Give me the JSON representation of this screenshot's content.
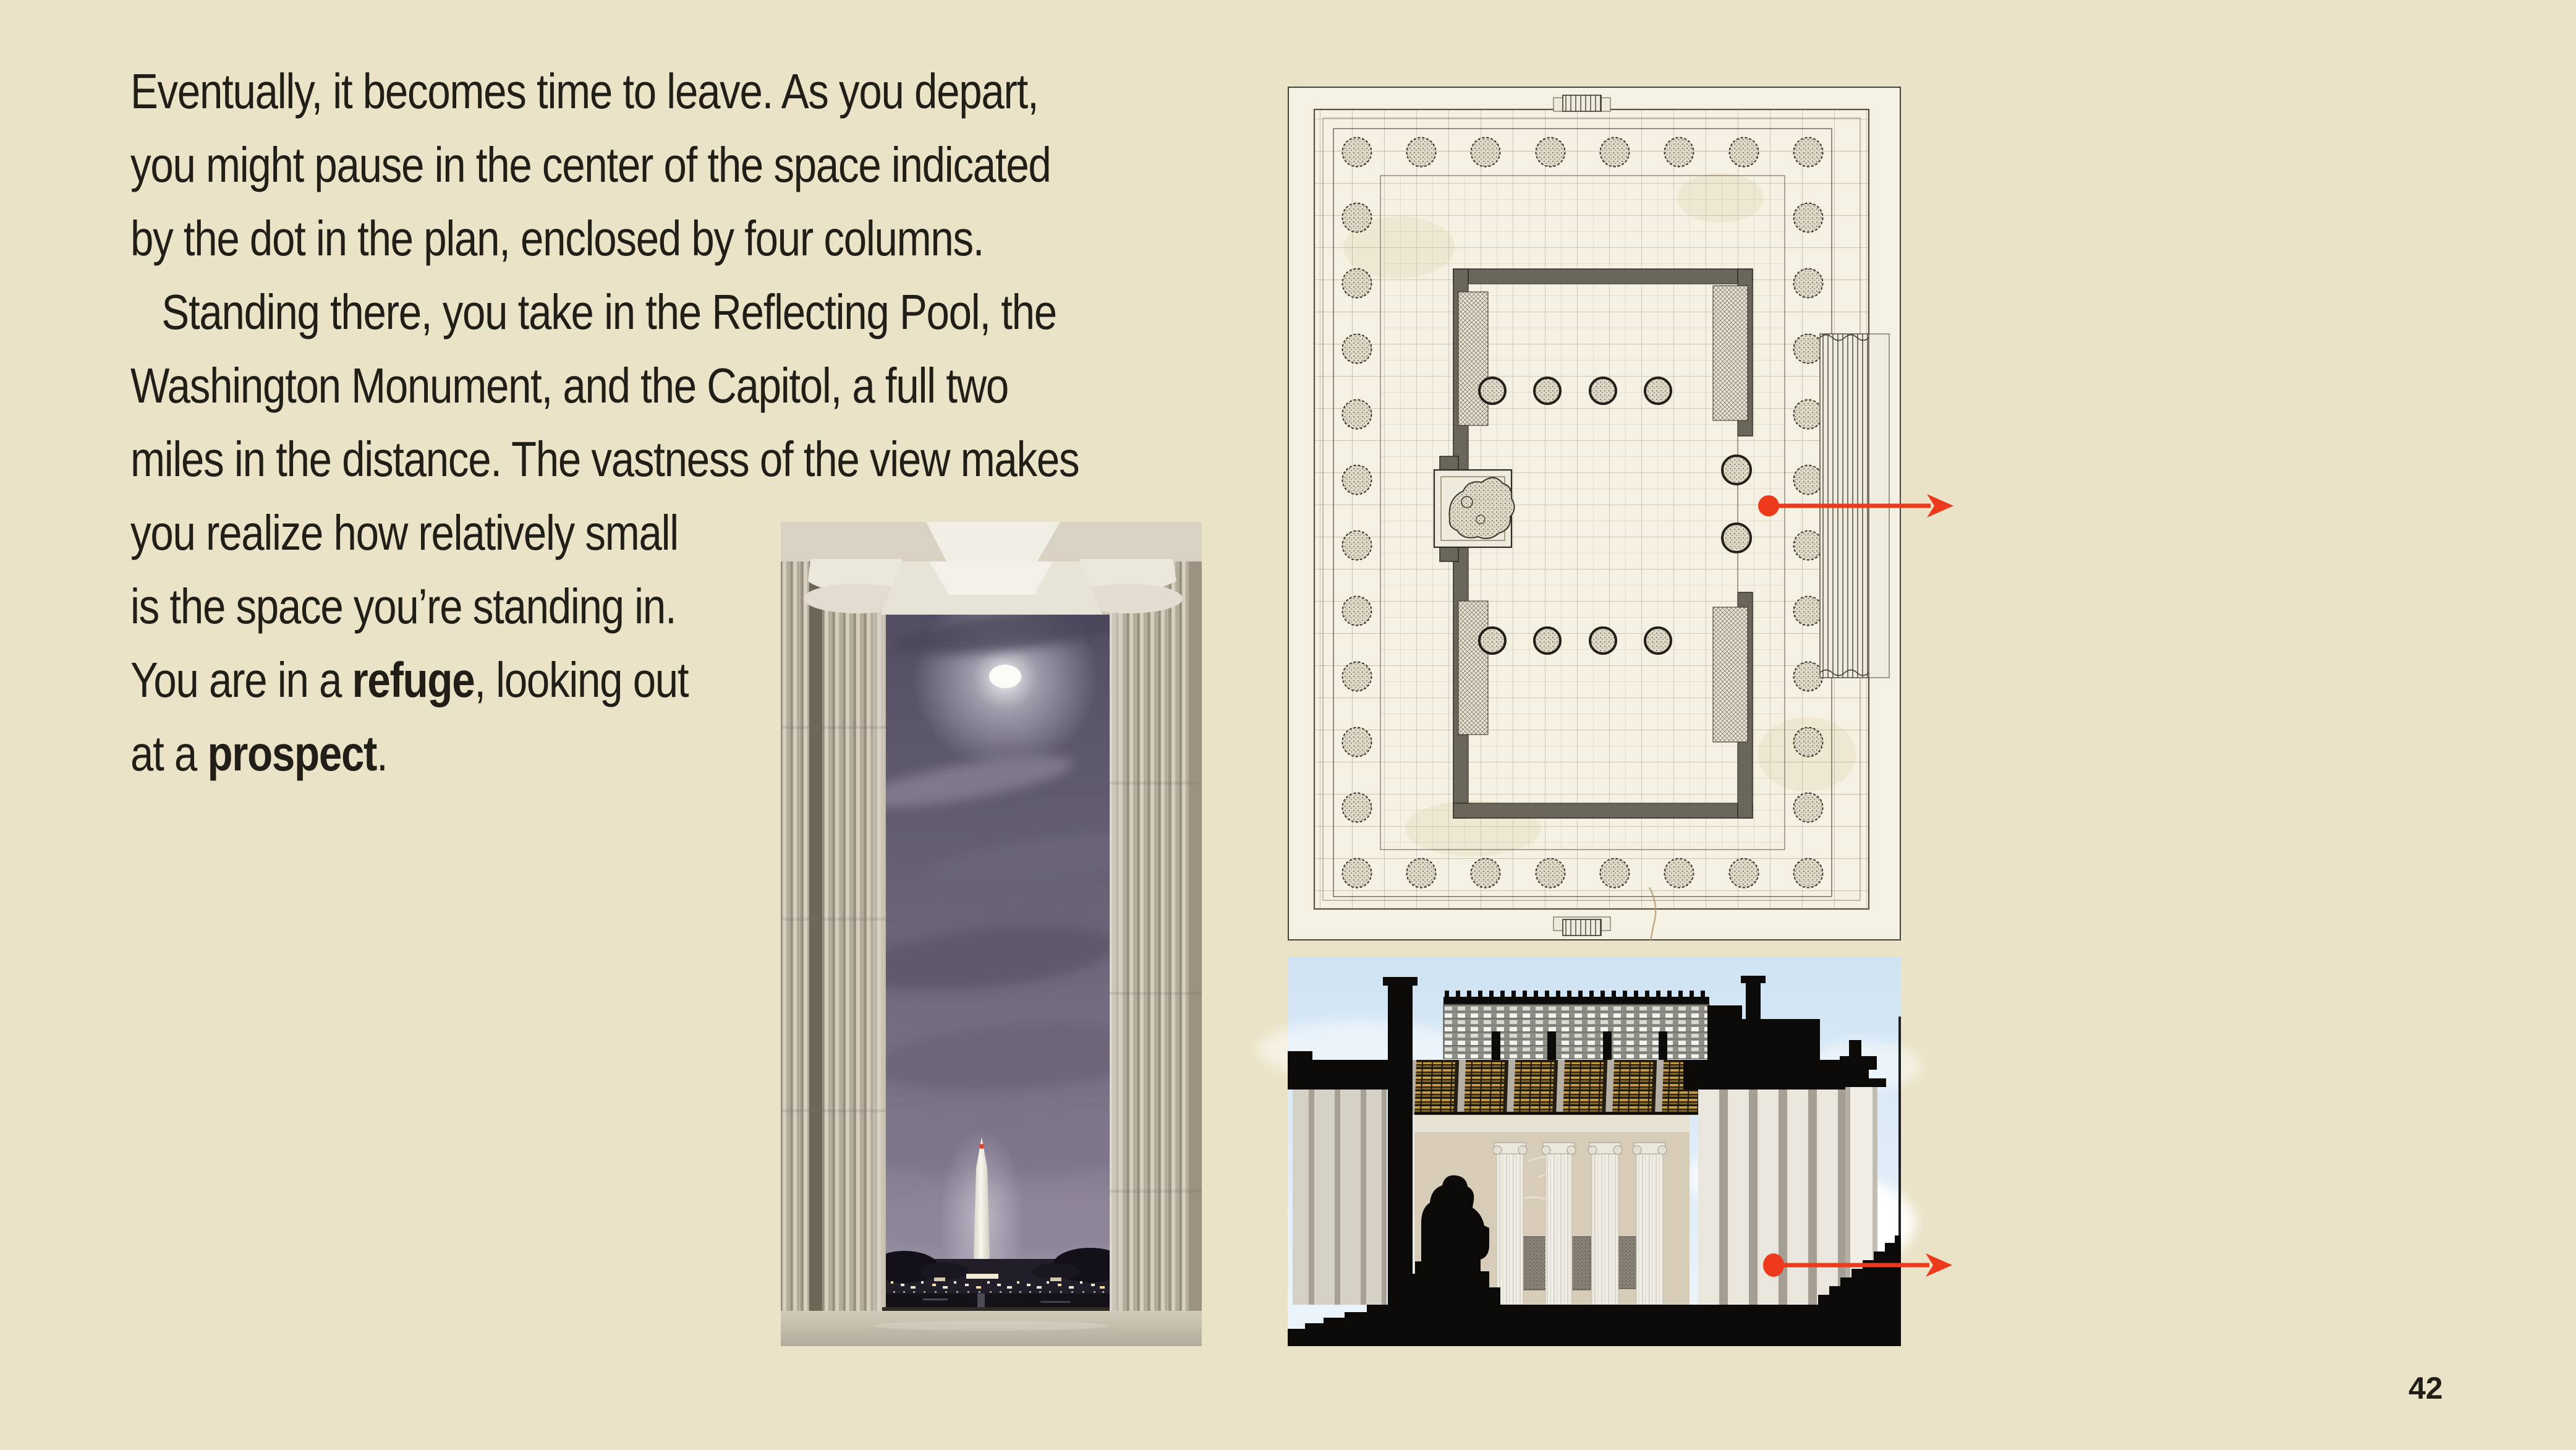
{
  "page": {
    "background": "#ebe3c7",
    "text_color": "#211e18",
    "accent_red": "#ee3a1c",
    "number": "42"
  },
  "paragraph": {
    "lines": [
      {
        "runs": [
          {
            "t": "Eventually, it becomes time to leave. As you depart,"
          }
        ]
      },
      {
        "runs": [
          {
            "t": "you might pause in the center of the space indicated"
          }
        ]
      },
      {
        "runs": [
          {
            "t": "by the dot in the plan, enclosed by four columns."
          }
        ]
      },
      {
        "indent": true,
        "runs": [
          {
            "t": "Standing there, you take in the Reflecting Pool, the"
          }
        ]
      },
      {
        "runs": [
          {
            "t": "Washington Monument, and the Capitol, a full two"
          }
        ]
      },
      {
        "runs": [
          {
            "t": "miles in the distance. The vastness of the view makes"
          }
        ]
      },
      {
        "runs": [
          {
            "t": "you realize how relatively small"
          }
        ]
      },
      {
        "runs": [
          {
            "t": "is the space you’re standing in."
          }
        ]
      },
      {
        "runs": [
          {
            "t": "You are in a "
          },
          {
            "t": "refuge",
            "bold": true
          },
          {
            "t": ", looking out"
          }
        ]
      },
      {
        "runs": [
          {
            "t": "at a "
          },
          {
            "t": "prospect",
            "bold": true
          },
          {
            "t": "."
          }
        ]
      }
    ]
  },
  "figures": {
    "photo": {
      "icon": "washington-monument-night-photo"
    },
    "plan": {
      "icon": "lincoln-memorial-floor-plan",
      "marker_color": "#ee3a1c"
    },
    "section": {
      "icon": "lincoln-memorial-section-drawing",
      "marker_color": "#ee3a1c"
    }
  }
}
